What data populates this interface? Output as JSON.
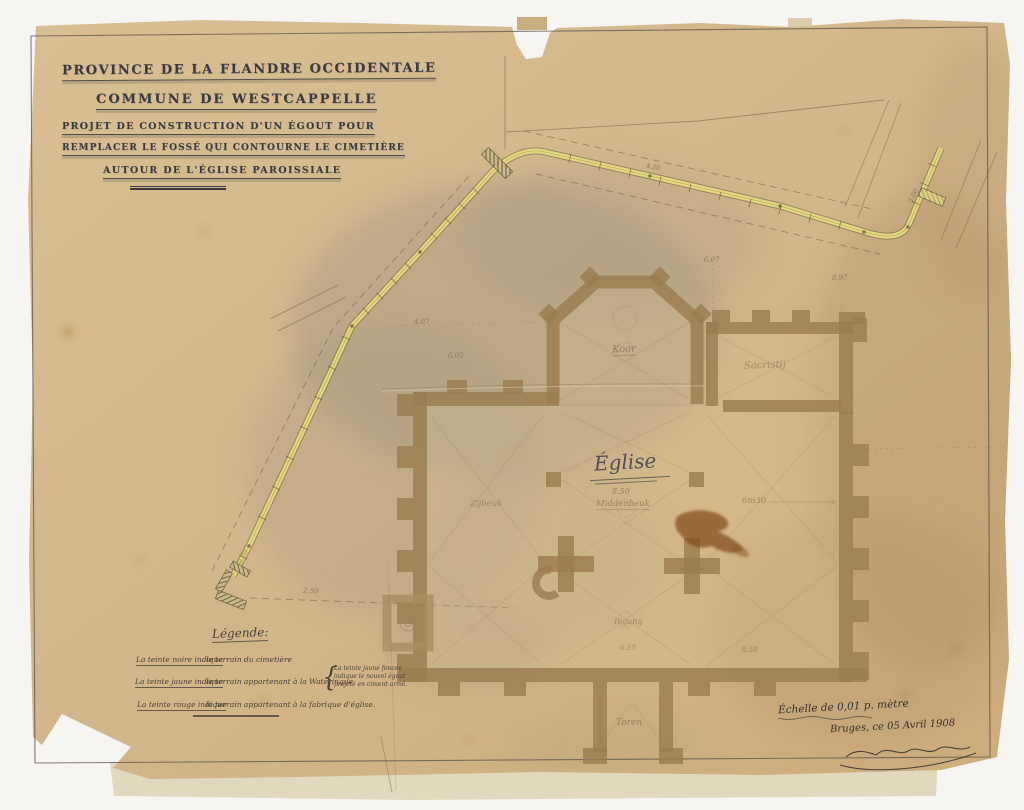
{
  "title_block": {
    "line1": "PROVINCE DE LA FLANDRE OCCIDENTALE",
    "line2": "COMMUNE DE WESTCAPPELLE",
    "line3": "PROJET DE CONSTRUCTION D'UN ÉGOUT POUR",
    "line4": "REMPLACER LE FOSSÉ QUI CONTOURNE LE CIMETIÈRE",
    "line5": "AUTOUR DE L'ÉGLISE PAROISSIALE"
  },
  "legend": {
    "heading": "Légende:",
    "items": [
      {
        "lead": "La teinte noire indique",
        "rest": "le terrain du cimetière"
      },
      {
        "lead": "La teinte jaune indique",
        "rest": "le terrain appartenant à la Wateringue"
      },
      {
        "lead": "La teinte rouge indique",
        "rest": "le terrain appartenant à la fabrique d'église."
      }
    ],
    "note_lines": [
      "La teinte jaune foncée",
      "indique le nouvel égout",
      "projeté en ciment armé."
    ]
  },
  "scale_block": {
    "scale": "Échelle de 0,01 p. mètre",
    "place_date": "Bruges, ce 05 Avril 1908"
  },
  "plan_labels": {
    "church": "Église",
    "choir": "Koor",
    "sacristy": "Sacristij",
    "nave": "Middenbeuk",
    "aisle_left": "Zijbeuk",
    "tower": "Toren",
    "entrance": "Ingang"
  },
  "dims": {
    "nave": "8.50",
    "aisle": "6m30",
    "t1": "6.07",
    "t2": "8.97",
    "l1": "4.07",
    "l2": "6.05",
    "b1": "6.10",
    "b2": "8.50",
    "ditch": "2.50",
    "m1": "0.70",
    "m2": "4.50",
    "m3": "5.00"
  },
  "colors": {
    "paper": "#d3b78c",
    "ink": "#3a3a40",
    "plan_brown": "#9c7c52",
    "sewer_yellow": "#e9dc82",
    "stain_gray": "#8f897d",
    "backing_strip": "#e2d8be"
  }
}
